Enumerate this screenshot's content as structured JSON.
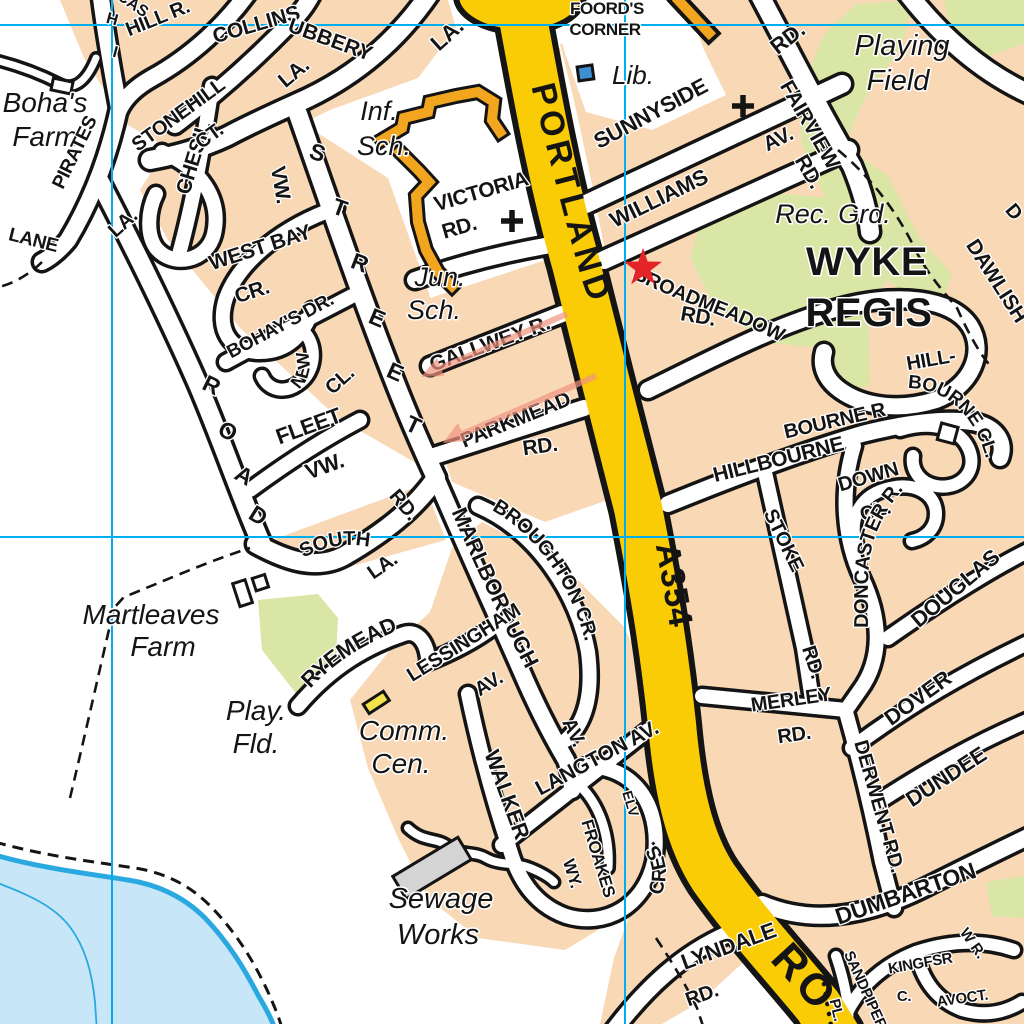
{
  "map": {
    "type": "street-atlas-page",
    "area_name": "WYKE REGIS",
    "colors": {
      "urban": "#F9D8B6",
      "road_fill": "#FFFFFF",
      "road_casing": "#141414",
      "main_road": "#FACC05",
      "green_space": "#D9E6A5",
      "water_fill": "#C7E6F8",
      "water_line": "#2AA9E0",
      "grid_line": "#00AEEF",
      "route_red": "#E42528",
      "arrow_salmon": "#F1937E",
      "school_orange": "#F2A51F",
      "library_blue": "#3D8FD1",
      "building_gray": "#D4D4D4",
      "building_yellow": "#F2E34D"
    },
    "grid": {
      "vertical_x": [
        112,
        625
      ],
      "horizontal_y": [
        25,
        537
      ]
    },
    "labels": [
      {
        "name": "bohas",
        "text": "Boha's",
        "x": 45,
        "y": 112,
        "size": 28,
        "style": "place"
      },
      {
        "name": "bohas-farm",
        "text": "Farm",
        "x": 45,
        "y": 146,
        "size": 28,
        "style": "place"
      },
      {
        "name": "inf",
        "text": "Inf.",
        "x": 379,
        "y": 120,
        "size": 27,
        "style": "place"
      },
      {
        "name": "inf-sch",
        "text": "Sch.",
        "x": 384,
        "y": 155,
        "size": 27,
        "style": "place"
      },
      {
        "name": "jun",
        "text": "Jun.",
        "x": 440,
        "y": 286,
        "size": 27,
        "style": "place"
      },
      {
        "name": "jun-sch",
        "text": "Sch.",
        "x": 434,
        "y": 319,
        "size": 27,
        "style": "place"
      },
      {
        "name": "lib",
        "text": "Lib.",
        "x": 633,
        "y": 84,
        "size": 26,
        "style": "place"
      },
      {
        "name": "playing",
        "text": "Playing",
        "x": 902,
        "y": 55,
        "size": 29,
        "style": "place"
      },
      {
        "name": "field",
        "text": "Field",
        "x": 898,
        "y": 90,
        "size": 29,
        "style": "place"
      },
      {
        "name": "rec-grd",
        "text": "Rec. Grd.",
        "x": 833,
        "y": 223,
        "size": 27,
        "style": "place"
      },
      {
        "name": "wyke",
        "text": "WYKE",
        "x": 867,
        "y": 275,
        "size": 40,
        "style": "big"
      },
      {
        "name": "regis",
        "text": "REGIS",
        "x": 869,
        "y": 326,
        "size": 40,
        "style": "big"
      },
      {
        "name": "martleaves",
        "text": "Martleaves",
        "x": 151,
        "y": 624,
        "size": 28,
        "style": "place"
      },
      {
        "name": "martleaves-farm",
        "text": "Farm",
        "x": 163,
        "y": 656,
        "size": 28,
        "style": "place"
      },
      {
        "name": "play-fld-1",
        "text": "Play.",
        "x": 256,
        "y": 720,
        "size": 28,
        "style": "place"
      },
      {
        "name": "play-fld-2",
        "text": "Fld.",
        "x": 256,
        "y": 753,
        "size": 28,
        "style": "place"
      },
      {
        "name": "comm",
        "text": "Comm.",
        "x": 404,
        "y": 740,
        "size": 28,
        "style": "place"
      },
      {
        "name": "cen",
        "text": "Cen.",
        "x": 401,
        "y": 773,
        "size": 28,
        "style": "place"
      },
      {
        "name": "sewage",
        "text": "Sewage",
        "x": 441,
        "y": 908,
        "size": 29,
        "style": "place"
      },
      {
        "name": "works",
        "text": "Works",
        "x": 438,
        "y": 944,
        "size": 29,
        "style": "place"
      },
      {
        "name": "foords",
        "text": "FOORD'S",
        "x": 607,
        "y": 14,
        "size": 17,
        "style": "street"
      },
      {
        "name": "corner",
        "text": "CORNER",
        "x": 605,
        "y": 35,
        "size": 17,
        "style": "street"
      },
      {
        "name": "portland",
        "text": "PORTLAND",
        "path": "pPortland",
        "size": 34,
        "ls": 5,
        "style": "onmain"
      },
      {
        "name": "road-big",
        "text": "RO",
        "path": "pRoadBig",
        "size": 44,
        "ls": 4,
        "style": "onmain"
      },
      {
        "name": "a354",
        "text": "A354",
        "path": "pA354",
        "size": 34,
        "ls": 1,
        "style": "route",
        "fill": "#E42528"
      },
      {
        "name": "sunnyside",
        "text": "SUNNYSIDE",
        "x": 654,
        "y": 120,
        "rot": -28,
        "size": 22,
        "style": "street"
      },
      {
        "name": "williams",
        "text": "WILLIAMS",
        "x": 662,
        "y": 205,
        "rot": -26,
        "size": 22,
        "style": "street"
      },
      {
        "name": "williams-av",
        "text": "AV.",
        "x": 781,
        "y": 145,
        "rot": -26,
        "size": 21,
        "style": "street"
      },
      {
        "name": "fairview",
        "text": "FAIRVIEW",
        "x": 804,
        "y": 128,
        "rot": 60,
        "size": 21,
        "style": "street"
      },
      {
        "name": "fairview-rd",
        "text": "RD.",
        "x": 803,
        "y": 175,
        "rot": 60,
        "size": 21,
        "style": "street"
      },
      {
        "name": "rd-top",
        "text": "RD.",
        "x": 792,
        "y": 44,
        "rot": -38,
        "size": 22,
        "style": "street"
      },
      {
        "name": "victoria",
        "text": "VICTORIA",
        "x": 483,
        "y": 198,
        "rot": -16,
        "size": 21,
        "style": "street"
      },
      {
        "name": "victoria-rd",
        "text": "RD.",
        "x": 461,
        "y": 234,
        "rot": -16,
        "size": 21,
        "style": "street"
      },
      {
        "name": "gallwey",
        "text": "GALLWEY R.",
        "x": 492,
        "y": 350,
        "rot": -20,
        "size": 21,
        "style": "street"
      },
      {
        "name": "parkmead",
        "text": "PARKMEAD",
        "x": 518,
        "y": 426,
        "rot": -22,
        "size": 21,
        "style": "street"
      },
      {
        "name": "parkmead-rd",
        "text": "RD.",
        "x": 541,
        "y": 453,
        "rot": -8,
        "size": 21,
        "style": "street"
      },
      {
        "name": "broadmeadow",
        "text": "BROADMEADOW",
        "path": "pBroad",
        "size": 20,
        "style": "street"
      },
      {
        "name": "broadmeadow-rd",
        "text": "RD.",
        "x": 697,
        "y": 323,
        "rot": 10,
        "size": 21,
        "style": "street"
      },
      {
        "name": "hill-part",
        "text": "HILL-",
        "x": 932,
        "y": 366,
        "rot": -10,
        "size": 20,
        "style": "street"
      },
      {
        "name": "bourne-part",
        "text": "BOURNE R",
        "x": 836,
        "y": 427,
        "rot": -13,
        "size": 20,
        "style": "street"
      },
      {
        "name": "bourne-cl",
        "text": "BOURNE CL.",
        "path": "pBourneCl",
        "size": 19,
        "style": "street"
      },
      {
        "name": "dawlish",
        "text": "DAWLISH",
        "path": "pDawlish",
        "size": 21,
        "style": "street"
      },
      {
        "name": "d-frag",
        "text": "D",
        "x": 1009,
        "y": 216,
        "rot": 50,
        "size": 20,
        "style": "frag"
      },
      {
        "name": "hillbourne",
        "text": "HILLBOURNE",
        "x": 780,
        "y": 466,
        "rot": -14,
        "size": 21,
        "style": "street"
      },
      {
        "name": "down",
        "text": "DOWN",
        "x": 870,
        "y": 483,
        "rot": -16,
        "size": 20,
        "style": "street"
      },
      {
        "name": "down-cl",
        "text": "CL.",
        "x": 877,
        "y": 517,
        "rot": -16,
        "size": 20,
        "style": "street"
      },
      {
        "name": "doncaster",
        "text": "DONCASTER R.",
        "path": "pDoncaster",
        "size": 20,
        "style": "street"
      },
      {
        "name": "douglas",
        "text": "DOUGLAS",
        "x": 960,
        "y": 594,
        "rot": -40,
        "size": 22,
        "style": "street"
      },
      {
        "name": "dover",
        "text": "DOVER",
        "x": 922,
        "y": 704,
        "rot": -36,
        "size": 22,
        "style": "street"
      },
      {
        "name": "stoke",
        "text": "STOKE",
        "path": "pStoke",
        "size": 20,
        "style": "street"
      },
      {
        "name": "stoke-rd",
        "text": "RD.",
        "x": 807,
        "y": 664,
        "rot": 72,
        "size": 20,
        "style": "street"
      },
      {
        "name": "merley",
        "text": "MERLEY",
        "x": 792,
        "y": 706,
        "rot": -8,
        "size": 20,
        "style": "street"
      },
      {
        "name": "merley-rd",
        "text": "RD.",
        "x": 795,
        "y": 741,
        "rot": -8,
        "size": 20,
        "style": "street"
      },
      {
        "name": "derwent",
        "text": "DERWENT RD.",
        "path": "pDerwent",
        "size": 20,
        "style": "street"
      },
      {
        "name": "dundee",
        "text": "DUNDEE",
        "x": 950,
        "y": 783,
        "rot": -33,
        "size": 22,
        "style": "street"
      },
      {
        "name": "dumbarton",
        "text": "DUMBARTON",
        "x": 908,
        "y": 901,
        "rot": -19,
        "size": 23,
        "style": "street"
      },
      {
        "name": "lyndale",
        "text": "LYNDALE",
        "x": 731,
        "y": 953,
        "rot": -20,
        "size": 22,
        "style": "street"
      },
      {
        "name": "lyndale-rd",
        "text": "RD.",
        "x": 704,
        "y": 1001,
        "rot": -20,
        "size": 20,
        "style": "street"
      },
      {
        "name": "kingfsr",
        "text": "KINGFSR",
        "x": 921,
        "y": 968,
        "rot": -10,
        "size": 15,
        "style": "street"
      },
      {
        "name": "kingfsr-c",
        "text": "C.",
        "x": 904,
        "y": 1001,
        "rot": 0,
        "size": 15,
        "style": "street"
      },
      {
        "name": "avoct",
        "text": "AVOCT.",
        "x": 963,
        "y": 1003,
        "rot": -8,
        "size": 15,
        "style": "street"
      },
      {
        "name": "sandpiper",
        "text": "SANDPIPER",
        "path": "pSandpiper",
        "size": 15,
        "style": "street"
      },
      {
        "name": "sandpiper-pl",
        "text": "PL.",
        "x": 832,
        "y": 1011,
        "rot": 76,
        "size": 15,
        "style": "street"
      },
      {
        "name": "wr-frag",
        "text": "W R.",
        "x": 969,
        "y": 946,
        "rot": 55,
        "size": 15,
        "style": "frag"
      },
      {
        "name": "langton",
        "text": "LANGTON AV.",
        "x": 600,
        "y": 764,
        "rot": -28,
        "size": 21,
        "style": "street"
      },
      {
        "name": "walker",
        "text": "WALKER",
        "x": 500,
        "y": 797,
        "rot": 70,
        "size": 22,
        "style": "street"
      },
      {
        "name": "cres",
        "text": "CRES.",
        "path": "pCres",
        "size": 20,
        "style": "street"
      },
      {
        "name": "froakes",
        "text": "FROAKES",
        "x": 593,
        "y": 860,
        "rot": 73,
        "size": 17,
        "style": "street"
      },
      {
        "name": "froakes-wy",
        "text": "WY.",
        "x": 567,
        "y": 875,
        "rot": 73,
        "size": 17,
        "style": "street"
      },
      {
        "name": "elv-frag",
        "text": "ELV",
        "x": 626,
        "y": 805,
        "rot": 73,
        "size": 14,
        "style": "frag"
      },
      {
        "name": "marlborough",
        "text": "MARLBOROUGH",
        "path": "pMarl",
        "size": 22,
        "style": "street"
      },
      {
        "name": "marlborough-av",
        "text": "AV.",
        "x": 568,
        "y": 735,
        "rot": 65,
        "size": 20,
        "style": "street"
      },
      {
        "name": "broughton",
        "text": "BROUGHTON CR.",
        "path": "pBroughton",
        "size": 20,
        "style": "street"
      },
      {
        "name": "lessingham",
        "text": "LESSINGHAM",
        "x": 467,
        "y": 648,
        "rot": -32,
        "size": 20,
        "style": "street"
      },
      {
        "name": "lessingham-av",
        "text": "AV.",
        "x": 492,
        "y": 689,
        "rot": -32,
        "size": 20,
        "style": "street"
      },
      {
        "name": "ryemead",
        "text": "RYEMEAD",
        "path": "pRyemead",
        "size": 22,
        "style": "street"
      },
      {
        "name": "south",
        "text": "SOUTH",
        "path": "pSouth",
        "size": 20,
        "style": "street"
      },
      {
        "name": "south-la",
        "text": "LA.",
        "x": 386,
        "y": 571,
        "rot": -35,
        "size": 20,
        "style": "street"
      },
      {
        "name": "south-rd",
        "text": "RD.",
        "x": 399,
        "y": 509,
        "rot": 50,
        "size": 20,
        "style": "street"
      },
      {
        "name": "street-s",
        "text": "S",
        "x": 315,
        "y": 160,
        "rot": 18,
        "size": 23,
        "style": "street"
      },
      {
        "name": "street-t1",
        "text": "T",
        "x": 337,
        "y": 215,
        "rot": 20,
        "size": 23,
        "style": "street"
      },
      {
        "name": "street-r",
        "text": "R",
        "x": 357,
        "y": 270,
        "rot": 21,
        "size": 23,
        "style": "street"
      },
      {
        "name": "street-e1",
        "text": "E",
        "x": 374,
        "y": 325,
        "rot": 23,
        "size": 23,
        "style": "street"
      },
      {
        "name": "street-e2",
        "text": "E",
        "x": 392,
        "y": 379,
        "rot": 24,
        "size": 23,
        "style": "street"
      },
      {
        "name": "street-t2",
        "text": "T",
        "x": 410,
        "y": 432,
        "rot": 25,
        "size": 23,
        "style": "street"
      },
      {
        "name": "road-r",
        "text": "R",
        "x": 208,
        "y": 392,
        "rot": 26,
        "size": 23,
        "style": "street"
      },
      {
        "name": "road-o",
        "text": "O",
        "x": 224,
        "y": 438,
        "rot": 28,
        "size": 23,
        "style": "street"
      },
      {
        "name": "road-a",
        "text": "A",
        "x": 240,
        "y": 482,
        "rot": 30,
        "size": 23,
        "style": "street"
      },
      {
        "name": "road-d",
        "text": "D",
        "x": 254,
        "y": 522,
        "rot": 32,
        "size": 23,
        "style": "street"
      },
      {
        "name": "pirates",
        "text": "PIRATES",
        "x": 80,
        "y": 155,
        "rot": -64,
        "size": 19,
        "style": "street"
      },
      {
        "name": "pirates-la",
        "text": "LA.",
        "x": 127,
        "y": 228,
        "rot": -42,
        "size": 20,
        "style": "street"
      },
      {
        "name": "lane",
        "text": "LANE",
        "x": 32,
        "y": 246,
        "rot": 14,
        "size": 19,
        "ls": 4,
        "style": "street"
      },
      {
        "name": "chesil",
        "text": "CHESIL",
        "x": 200,
        "y": 160,
        "rot": -73,
        "size": 21,
        "style": "street"
      },
      {
        "name": "chesil-vw",
        "text": "VW.",
        "x": 274,
        "y": 186,
        "rot": 80,
        "size": 21,
        "style": "street"
      },
      {
        "name": "stonehill",
        "text": "STONEHILL",
        "x": 182,
        "y": 120,
        "rot": -36,
        "size": 20,
        "style": "street"
      },
      {
        "name": "stonehill-ct",
        "text": "CT.",
        "x": 213,
        "y": 141,
        "rot": -36,
        "size": 20,
        "style": "street"
      },
      {
        "name": "west-bay",
        "text": "WEST BAY",
        "x": 262,
        "y": 254,
        "rot": -18,
        "size": 21,
        "style": "street"
      },
      {
        "name": "west-bay-cr",
        "text": "CR.",
        "x": 254,
        "y": 298,
        "rot": -18,
        "size": 21,
        "style": "street"
      },
      {
        "name": "bohays-dr",
        "text": "BOHAY'S DR.",
        "x": 283,
        "y": 331,
        "rot": -28,
        "size": 19,
        "style": "street"
      },
      {
        "name": "new",
        "text": "NEW",
        "path": "pNew",
        "size": 18,
        "style": "street"
      },
      {
        "name": "new-cl",
        "text": "CL.",
        "x": 344,
        "y": 385,
        "rot": -42,
        "size": 20,
        "style": "street"
      },
      {
        "name": "fleet",
        "text": "FLEET",
        "x": 311,
        "y": 433,
        "rot": -20,
        "size": 22,
        "style": "street"
      },
      {
        "name": "fleet-vw",
        "text": "VW.",
        "x": 327,
        "y": 473,
        "rot": -20,
        "size": 22,
        "style": "street"
      },
      {
        "name": "hill-r",
        "text": "HILL R.",
        "x": 160,
        "y": 24,
        "rot": -22,
        "size": 20,
        "style": "street"
      },
      {
        "name": "collins",
        "text": "COLLINS",
        "x": 258,
        "y": 31,
        "rot": -16,
        "size": 21,
        "style": "street"
      },
      {
        "name": "collins-la",
        "text": "LA.",
        "x": 298,
        "y": 78,
        "rot": -40,
        "size": 21,
        "style": "street"
      },
      {
        "name": "ubbery-frag",
        "text": "UBBERY",
        "x": 328,
        "y": 46,
        "rot": 20,
        "size": 21,
        "style": "frag"
      },
      {
        "name": "la-top-frag",
        "text": "LA.",
        "x": 452,
        "y": 40,
        "rot": -42,
        "size": 22,
        "style": "frag"
      },
      {
        "name": "cas-frag",
        "text": "CAS",
        "x": 130,
        "y": 8,
        "rot": 35,
        "size": 16,
        "style": "frag"
      },
      {
        "name": "h-frag",
        "text": "H",
        "x": 111,
        "y": 24,
        "rot": 15,
        "size": 16,
        "style": "frag"
      },
      {
        "name": "i-frag",
        "text": "I",
        "x": 114,
        "y": 57,
        "rot": 15,
        "size": 16,
        "style": "frag"
      }
    ]
  }
}
